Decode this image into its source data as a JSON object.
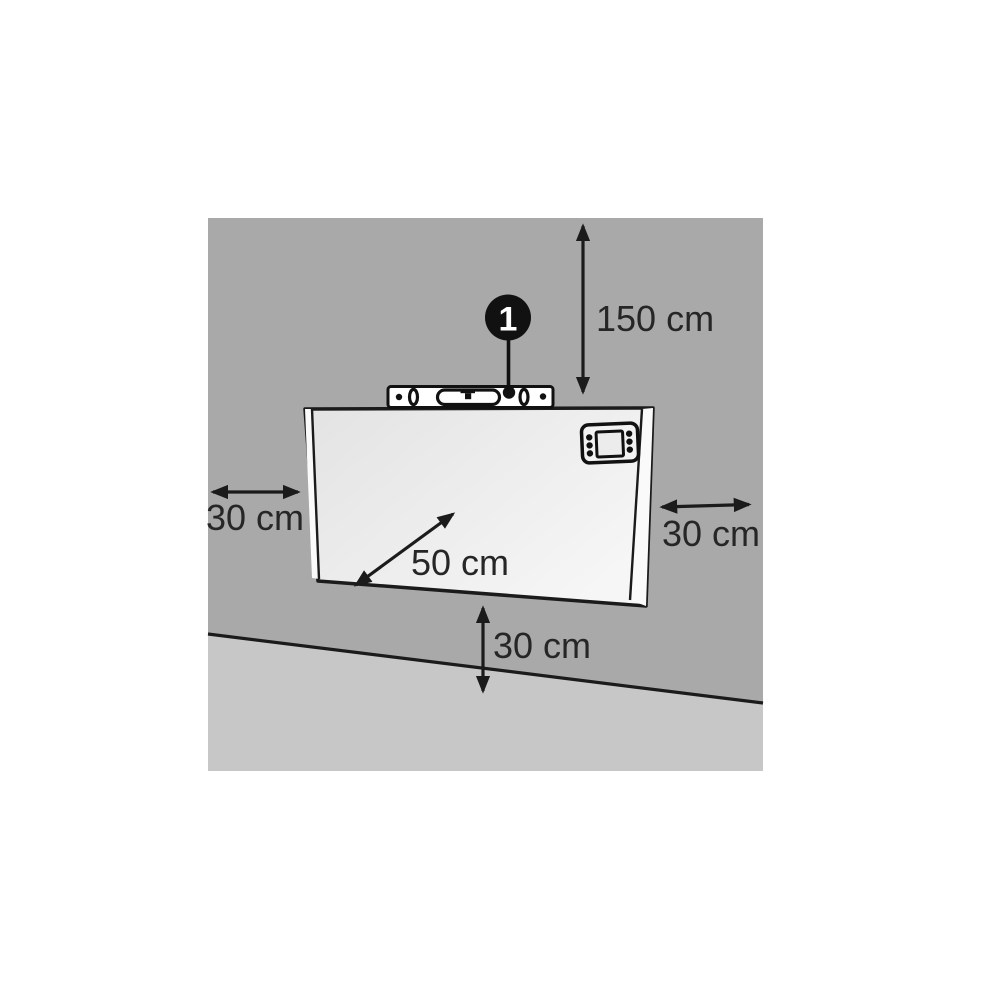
{
  "diagram": {
    "title": "heater-wall-mount-clearance-diagram",
    "callout": {
      "number": "1"
    },
    "dimensions": {
      "top_clearance": "150 cm",
      "left_clearance": "30 cm",
      "right_clearance": "30 cm",
      "bottom_clearance": "30 cm",
      "diagonal": "50 cm"
    },
    "colors": {
      "wall": "#a9a9a9",
      "floor": "#c7c7c7",
      "floor_line": "#1b1b1b",
      "heater_light": "#e3e3e3",
      "heater_lighter": "#f6f6f6",
      "side_face": "#fafafa",
      "outline": "#1b1b1b",
      "text": "#262626",
      "callout_fill": "#111111",
      "callout_text": "#ffffff",
      "level_fill": "#ffffff"
    }
  }
}
